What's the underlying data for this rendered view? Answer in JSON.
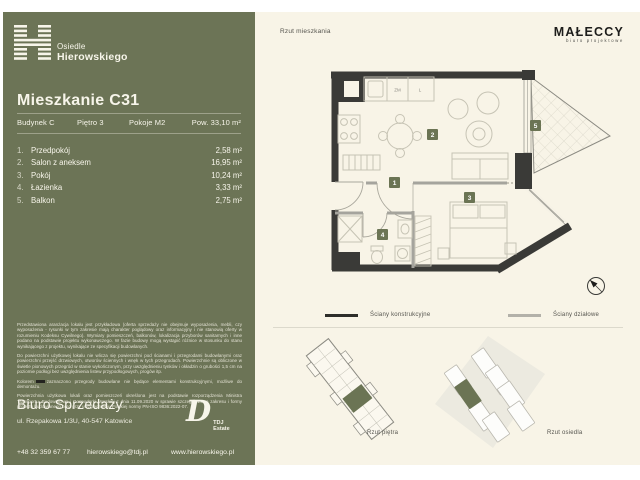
{
  "brand": {
    "line1": "Osiedle",
    "line2": "Hierowskiego"
  },
  "apartment": {
    "title": "Mieszkanie C31",
    "building": "Budynek C",
    "floor": "Piętro 3",
    "rooms_type": "Pokoje M2",
    "area": "Pow. 33,10 m²"
  },
  "room_list": [
    {
      "no": "1.",
      "name": "Przedpokój",
      "area": "2,58 m²"
    },
    {
      "no": "2.",
      "name": "Salon z aneksem",
      "area": "16,95 m²"
    },
    {
      "no": "3.",
      "name": "Pokój",
      "area": "10,24 m²"
    },
    {
      "no": "4.",
      "name": "Łazienka",
      "area": "3,33 m²"
    },
    {
      "no": "5.",
      "name": "Balkon",
      "area": "2,75 m²"
    }
  ],
  "disclaimer": {
    "p1": "Przedstawiona aranżacja lokalu jest przykładowa (oferta sprzedaży nie obejmuje wyposażenia, mebli, czy wyposażenia - rysunki w tym zakresie mają charakter poglądowy oraz informacyjny i nie stanowią oferty w rozumieniu Kodeksu Cywilnego). Wymiary pomieszczeń, balkonów, lokalizacja przyborów sanitarnych i inne podano na podstawie projektu wykonawczego. W fazie budowy mogą wystąpić różnice w stosunku do stanu wynikającego z projektu, wynikające ze specyfikacji budowlanych.",
    "p2": "Do powierzchni użytkowej lokalu nie wlicza się powierzchni pod ścianami i przegrodami budowlanymi oraz powierzchni przejść drzwiowych, otworów ściennych i wnęk w tych przegrodach. Powierzchnie są obliczone w świetle pionowych przegród w stanie wykończonym, przy uwzględnieniu tynków i okładzin o grubości 1,5 cm na poziomie podłogi bez uwzględnienia listew przypodłogowych, progów itp.",
    "p3_prefix": "Kolorem",
    "p3_suffix": "zaznaczono przegrody budowlane nie będące elementami konstrukcyjnymi, możliwe do demontażu.",
    "p4": "Powierzchnia użytkowa lokali oraz pomieszczeń określona jest na podstawie rozporządzenia Ministra Transportu, Budownictwa i Gospodarki Morskiej z dnia 11.09.2020 w sprawie szczegółowego zakresu i formy projektu budowlanego oraz przy uwzględnieniu Polskiej normy PN-ISO 9836:2022-07."
  },
  "sales_office": {
    "title": "Biuro Sprzedaży",
    "address": "ul. Rzepakowa 1/3U, 40-547 Katowice",
    "phone": "+48 32 359 67 77",
    "email": "hierowskiego@tdj.pl",
    "website": "www.hierowskiego.pl"
  },
  "tdj": {
    "glyph": "D",
    "line1": "TDJ",
    "line2": "Estate"
  },
  "plan": {
    "caption": "Rzut mieszkania",
    "labels": {
      "zm": "ZM",
      "l": "L"
    },
    "badges": [
      "1",
      "2",
      "3",
      "4",
      "5"
    ]
  },
  "architect": {
    "name": "MAŁECCY",
    "subtitle": "biuro projektowe"
  },
  "legend": {
    "structural": "Ściany konstrukcyjne",
    "partition": "Ściany działowe"
  },
  "mini_plans": {
    "floor": "Rzut piętra",
    "estate": "Rzut osiedla"
  },
  "colors": {
    "panel_green": "#6C7456",
    "cream": "#F8F4E7",
    "wall_dark": "#3A3A37",
    "partition_gray": "#A5A49D",
    "badge_green": "#6B7454",
    "text_dark": "#1D1D1B"
  }
}
